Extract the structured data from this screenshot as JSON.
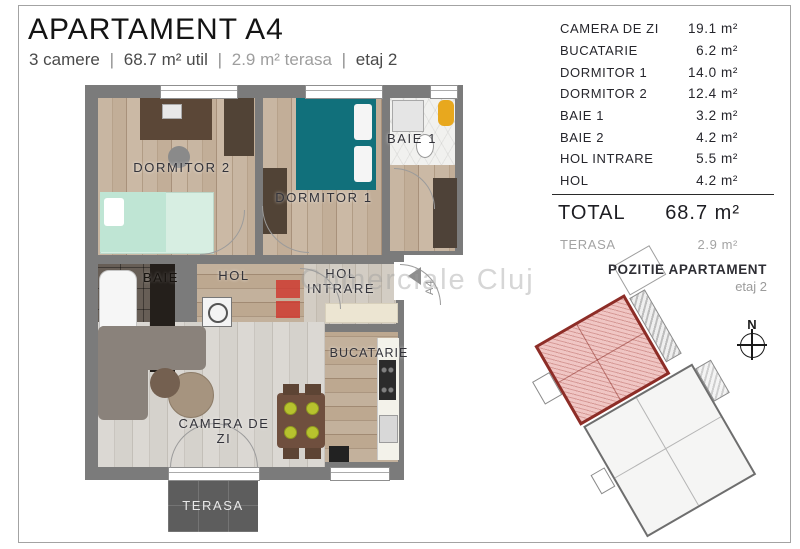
{
  "header": {
    "title": "APARTAMENT A4",
    "subtitle": {
      "rooms": "3 camere",
      "divider": "|",
      "util": "68.7 m²  util",
      "terasa": "2.9 m²  terasa",
      "floor": "etaj 2"
    }
  },
  "plan": {
    "labels": {
      "dormitor2": "DORMITOR 2",
      "dormitor1": "DORMITOR 1",
      "baie1": "BAIE 1",
      "baie": "BAIE",
      "hol": "HOL",
      "hol_intrare": "HOL INTRARE",
      "bucatarie": "BUCATARIE",
      "camera_de_zi": "CAMERA DE ZI",
      "terasa": "TERASA"
    },
    "entrance_marker": "A4"
  },
  "watermark": "Comerciale Cluj",
  "areas_table": {
    "rows": [
      {
        "label": "CAMERA DE ZI",
        "area": "19.1 m²"
      },
      {
        "label": "BUCATARIE",
        "area": "6.2 m²"
      },
      {
        "label": "DORMITOR 1",
        "area": "14.0 m²"
      },
      {
        "label": "DORMITOR 2",
        "area": "12.4 m²"
      },
      {
        "label": "BAIE 1",
        "area": "3.2 m²"
      },
      {
        "label": "BAIE 2",
        "area": "4.2 m²"
      },
      {
        "label": "HOL INTRARE",
        "area": "5.5 m²"
      },
      {
        "label": "HOL",
        "area": "4.2 m²"
      }
    ],
    "total": {
      "label": "TOTAL",
      "area": "68.7 m²"
    },
    "terasa": {
      "label": "TERASA",
      "area": "2.9 m²"
    }
  },
  "position": {
    "title": "POZITIE APARTAMENT",
    "subtitle": "etaj 2",
    "compass_label": "N"
  },
  "colors": {
    "accent_red": "#d0352c",
    "highlight_fill": "#f0c6c4",
    "highlight_border": "#8d2d27",
    "wall_gray": "#7b7b7b",
    "teal_bed": "#11707b"
  }
}
